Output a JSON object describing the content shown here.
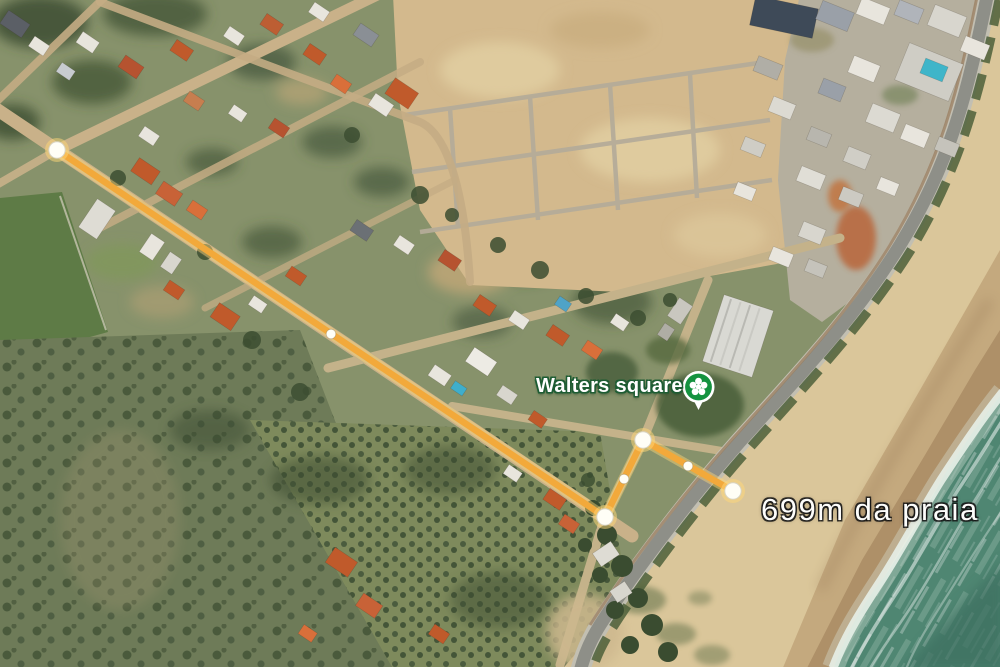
{
  "map": {
    "view": "satellite",
    "place_label": "Walters square",
    "distance_label": "699m da praia",
    "poi": {
      "icon": "park-flower-pin-icon",
      "pin_green": "#14923F",
      "pin_casing": "#FFFFFF"
    },
    "measurement": {
      "path_color": "#F2A93B",
      "glow_color": "#FFD778",
      "dot_fill": "#FFFEF6",
      "dot_ring": "#D8D4C4",
      "vertices": [
        [
          57,
          150
        ],
        [
          605,
          517
        ],
        [
          643,
          440
        ],
        [
          733,
          491
        ]
      ],
      "midpoints": [
        [
          331,
          334
        ],
        [
          624,
          479
        ],
        [
          688,
          466
        ]
      ]
    },
    "terrain_colors": {
      "ground": "#87926B",
      "dev_lot": "#D3B98D",
      "scrub": "#6E7B58",
      "orchard": "#7E8A5C",
      "field": "#5E7B46",
      "dirt_road": "#C9B189",
      "coastal_road": "#8E8F88",
      "sand_dry": "#DAC69A",
      "sand_wet": "#AE9068",
      "ocean": "#4F8672",
      "foam": "#DCE9DE",
      "roof_orange": "#C05A2B",
      "roof_white": "#E8E5DD"
    }
  }
}
